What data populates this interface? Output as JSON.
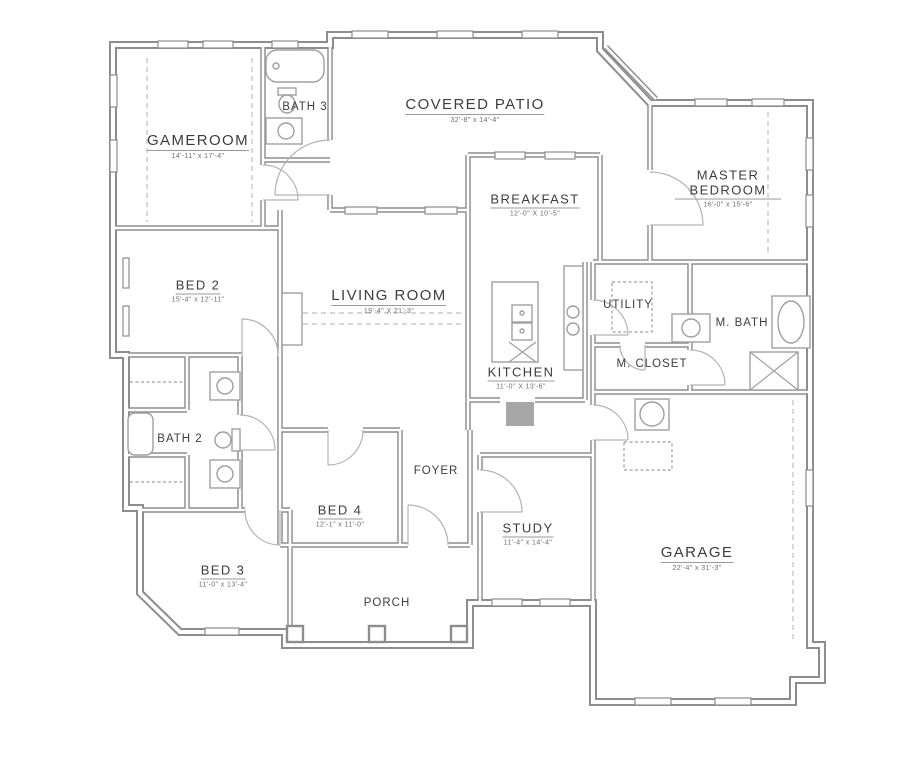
{
  "theme": {
    "background": "#ffffff",
    "wall": "#8d8d8d",
    "fixture": "#9f9f9f",
    "dash": "#bdbdbd",
    "label": "#3d3d3d",
    "dims": "#6e6e6e"
  },
  "plan": {
    "type": "residential-floor-plan",
    "rooms": [
      {
        "name": "GAMEROOM",
        "dims": "14'-11\" x 17'-4\""
      },
      {
        "name": "BATH 3",
        "dims": ""
      },
      {
        "name": "COVERED PATIO",
        "dims": "32'-8\" x 14'-4\""
      },
      {
        "name": "BREAKFAST",
        "dims": "12'-0\" X 10'-5\""
      },
      {
        "name": "MASTER BEDROOM",
        "dims": "16'-0\" x 15'-6\""
      },
      {
        "name": "BED 2",
        "dims": "15'-4\" x 12'-11\""
      },
      {
        "name": "LIVING ROOM",
        "dims": "19'-4\" X 21'-3\""
      },
      {
        "name": "UTILITY",
        "dims": ""
      },
      {
        "name": "M. BATH",
        "dims": ""
      },
      {
        "name": "KITCHEN",
        "dims": "11'-0\" X 13'-6\""
      },
      {
        "name": "M. CLOSET",
        "dims": ""
      },
      {
        "name": "BATH 2",
        "dims": ""
      },
      {
        "name": "FOYER",
        "dims": ""
      },
      {
        "name": "BED 4",
        "dims": "12'-1\" x 11'-0\""
      },
      {
        "name": "STUDY",
        "dims": "11'-4\" x 14'-4\""
      },
      {
        "name": "BED 3",
        "dims": "11'-0\" x 13'-4\""
      },
      {
        "name": "GARAGE",
        "dims": "22'-4\" x 31'-3\""
      },
      {
        "name": "PORCH",
        "dims": ""
      }
    ]
  }
}
